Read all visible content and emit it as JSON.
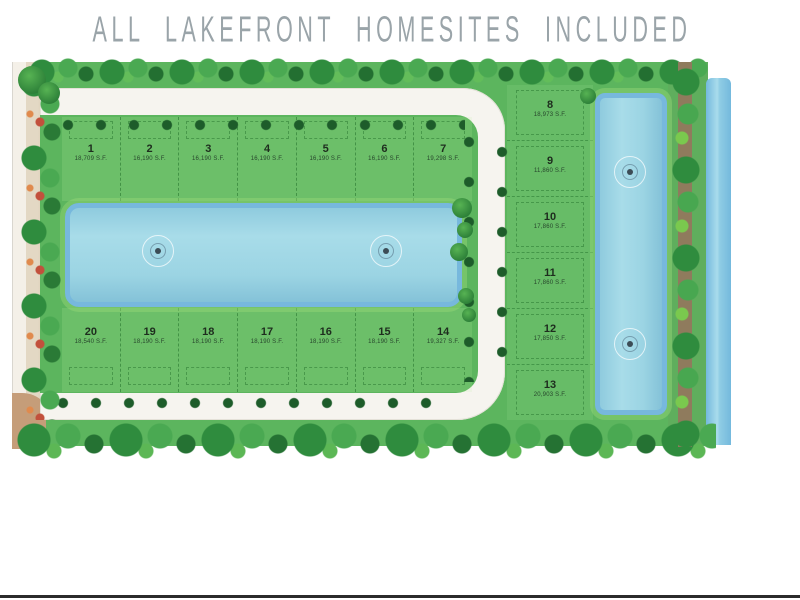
{
  "title": "ALL LAKEFRONT HOMESITES INCLUDED",
  "lots": [
    {
      "number": "1",
      "area": "18,709 S.F."
    },
    {
      "number": "2",
      "area": "16,190 S.F."
    },
    {
      "number": "3",
      "area": "16,190 S.F."
    },
    {
      "number": "4",
      "area": "16,190 S.F."
    },
    {
      "number": "5",
      "area": "16,190 S.F."
    },
    {
      "number": "6",
      "area": "16,190 S.F."
    },
    {
      "number": "7",
      "area": "19,298 S.F."
    },
    {
      "number": "8",
      "area": "18,973 S.F."
    },
    {
      "number": "9",
      "area": "11,860 S.F."
    },
    {
      "number": "10",
      "area": "17,860 S.F."
    },
    {
      "number": "11",
      "area": "17,860 S.F."
    },
    {
      "number": "12",
      "area": "17,850 S.F."
    },
    {
      "number": "13",
      "area": "20,903 S.F."
    },
    {
      "number": "14",
      "area": "19,327 S.F."
    },
    {
      "number": "15",
      "area": "18,190 S.F."
    },
    {
      "number": "16",
      "area": "18,190 S.F."
    },
    {
      "number": "17",
      "area": "18,190 S.F."
    },
    {
      "number": "18",
      "area": "18,190 S.F."
    },
    {
      "number": "19",
      "area": "18,190 S.F."
    },
    {
      "number": "20",
      "area": "18,540 S.F."
    }
  ],
  "features": {
    "central_lake": "rectangular lake with 2 fountains",
    "east_lake": "vertical lake with 2 fountains",
    "east_canal": "water strip along east boundary",
    "loop_road": "white interior loop street",
    "west_road": "tan perimeter road"
  },
  "icons": {
    "fountain": "concentric-circles",
    "tree": "green-circle",
    "shrub": "red-green-cluster"
  },
  "colors": {
    "field_green": "#5cb55e",
    "lot_green": "#6fc46d",
    "lake_blue": "#9bd4e3",
    "lake_edge_blue": "#77b8dd",
    "road_white": "#f6f4ef",
    "perimeter_tan": "#c59d79",
    "tree_green": "#2f8c3e",
    "title_gray": "#9aa4a9"
  }
}
